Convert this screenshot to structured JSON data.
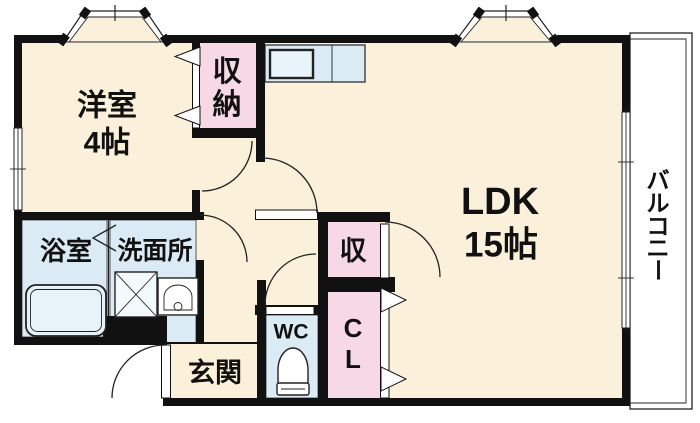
{
  "floorplan": {
    "rooms": {
      "western_room": {
        "name": "洋室",
        "size": "4帖"
      },
      "closet_west": {
        "chars": [
          "収",
          "納"
        ]
      },
      "ldk": {
        "name": "LDK",
        "size": "15帖"
      },
      "balcony": {
        "chars": [
          "バ",
          "ル",
          "コ",
          "ニ",
          "ー"
        ]
      },
      "bathroom": {
        "name": "浴室"
      },
      "washroom": {
        "name": "洗面所"
      },
      "wc": {
        "name": "WC"
      },
      "storage": {
        "name": "収"
      },
      "closet_cl": {
        "chars": [
          "C",
          "L"
        ]
      },
      "entrance": {
        "name": "玄関"
      }
    },
    "colors": {
      "floor": "#fbf1da",
      "closet_pink": "#f6d9e4",
      "wet_area_blue": "#daebf5",
      "wall": "#111111",
      "background": "#ffffff"
    }
  }
}
